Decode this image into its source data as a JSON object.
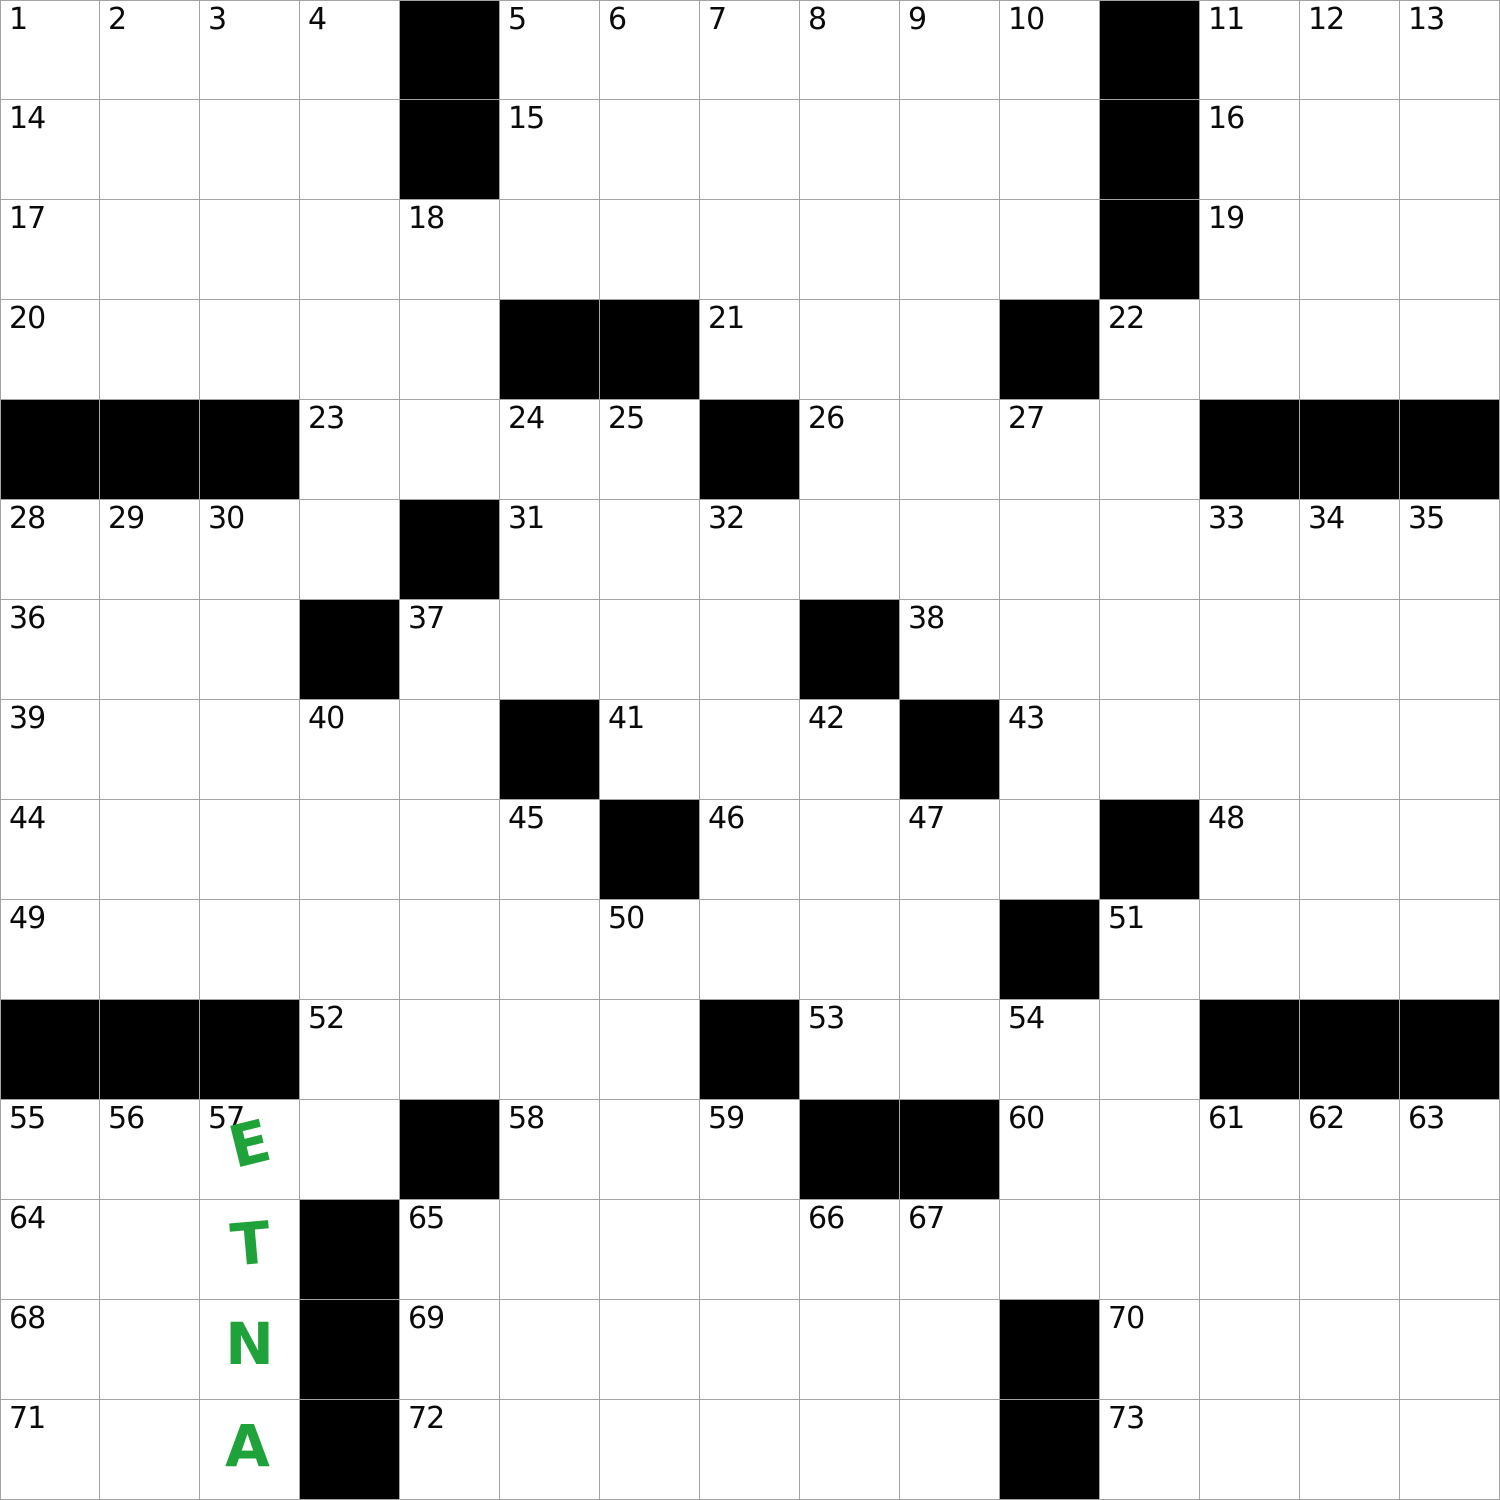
{
  "puzzle": {
    "rows": 15,
    "cols": 15,
    "cell_size": 100,
    "colors": {
      "background": "#ffffff",
      "black_cell": "#000000",
      "grid_line": "#a3a3a3",
      "number_text": "#0a0a0a",
      "entry_green": "#1fa23a"
    },
    "black_cells": [
      [
        0,
        4
      ],
      [
        0,
        11
      ],
      [
        1,
        4
      ],
      [
        1,
        11
      ],
      [
        2,
        11
      ],
      [
        3,
        5
      ],
      [
        3,
        6
      ],
      [
        3,
        10
      ],
      [
        4,
        0
      ],
      [
        4,
        1
      ],
      [
        4,
        2
      ],
      [
        4,
        7
      ],
      [
        4,
        12
      ],
      [
        4,
        13
      ],
      [
        4,
        14
      ],
      [
        5,
        4
      ],
      [
        6,
        3
      ],
      [
        6,
        8
      ],
      [
        7,
        5
      ],
      [
        7,
        9
      ],
      [
        8,
        6
      ],
      [
        8,
        11
      ],
      [
        9,
        10
      ],
      [
        10,
        0
      ],
      [
        10,
        1
      ],
      [
        10,
        2
      ],
      [
        10,
        7
      ],
      [
        10,
        12
      ],
      [
        10,
        13
      ],
      [
        10,
        14
      ],
      [
        11,
        4
      ],
      [
        11,
        8
      ],
      [
        11,
        9
      ],
      [
        12,
        3
      ],
      [
        13,
        3
      ],
      [
        13,
        10
      ],
      [
        14,
        3
      ],
      [
        14,
        10
      ]
    ],
    "numbers": [
      {
        "n": "1",
        "row": 0,
        "col": 0
      },
      {
        "n": "2",
        "row": 0,
        "col": 1
      },
      {
        "n": "3",
        "row": 0,
        "col": 2
      },
      {
        "n": "4",
        "row": 0,
        "col": 3
      },
      {
        "n": "5",
        "row": 0,
        "col": 5
      },
      {
        "n": "6",
        "row": 0,
        "col": 6
      },
      {
        "n": "7",
        "row": 0,
        "col": 7
      },
      {
        "n": "8",
        "row": 0,
        "col": 8
      },
      {
        "n": "9",
        "row": 0,
        "col": 9
      },
      {
        "n": "10",
        "row": 0,
        "col": 10
      },
      {
        "n": "11",
        "row": 0,
        "col": 12
      },
      {
        "n": "12",
        "row": 0,
        "col": 13
      },
      {
        "n": "13",
        "row": 0,
        "col": 14
      },
      {
        "n": "14",
        "row": 1,
        "col": 0
      },
      {
        "n": "15",
        "row": 1,
        "col": 5
      },
      {
        "n": "16",
        "row": 1,
        "col": 12
      },
      {
        "n": "17",
        "row": 2,
        "col": 0
      },
      {
        "n": "18",
        "row": 2,
        "col": 4
      },
      {
        "n": "19",
        "row": 2,
        "col": 12
      },
      {
        "n": "20",
        "row": 3,
        "col": 0
      },
      {
        "n": "21",
        "row": 3,
        "col": 7
      },
      {
        "n": "22",
        "row": 3,
        "col": 11
      },
      {
        "n": "23",
        "row": 4,
        "col": 3
      },
      {
        "n": "24",
        "row": 4,
        "col": 5
      },
      {
        "n": "25",
        "row": 4,
        "col": 6
      },
      {
        "n": "26",
        "row": 4,
        "col": 8
      },
      {
        "n": "27",
        "row": 4,
        "col": 10
      },
      {
        "n": "28",
        "row": 5,
        "col": 0
      },
      {
        "n": "29",
        "row": 5,
        "col": 1
      },
      {
        "n": "30",
        "row": 5,
        "col": 2
      },
      {
        "n": "31",
        "row": 5,
        "col": 5
      },
      {
        "n": "32",
        "row": 5,
        "col": 7
      },
      {
        "n": "33",
        "row": 5,
        "col": 12
      },
      {
        "n": "34",
        "row": 5,
        "col": 13
      },
      {
        "n": "35",
        "row": 5,
        "col": 14
      },
      {
        "n": "36",
        "row": 6,
        "col": 0
      },
      {
        "n": "37",
        "row": 6,
        "col": 4
      },
      {
        "n": "38",
        "row": 6,
        "col": 9
      },
      {
        "n": "39",
        "row": 7,
        "col": 0
      },
      {
        "n": "40",
        "row": 7,
        "col": 3
      },
      {
        "n": "41",
        "row": 7,
        "col": 6
      },
      {
        "n": "42",
        "row": 7,
        "col": 8
      },
      {
        "n": "43",
        "row": 7,
        "col": 10
      },
      {
        "n": "44",
        "row": 8,
        "col": 0
      },
      {
        "n": "45",
        "row": 8,
        "col": 5
      },
      {
        "n": "46",
        "row": 8,
        "col": 7
      },
      {
        "n": "47",
        "row": 8,
        "col": 9
      },
      {
        "n": "48",
        "row": 8,
        "col": 12
      },
      {
        "n": "49",
        "row": 9,
        "col": 0
      },
      {
        "n": "50",
        "row": 9,
        "col": 6
      },
      {
        "n": "51",
        "row": 9,
        "col": 11
      },
      {
        "n": "52",
        "row": 10,
        "col": 3
      },
      {
        "n": "53",
        "row": 10,
        "col": 8
      },
      {
        "n": "54",
        "row": 10,
        "col": 10
      },
      {
        "n": "55",
        "row": 11,
        "col": 0
      },
      {
        "n": "56",
        "row": 11,
        "col": 1
      },
      {
        "n": "57",
        "row": 11,
        "col": 2
      },
      {
        "n": "58",
        "row": 11,
        "col": 5
      },
      {
        "n": "59",
        "row": 11,
        "col": 7
      },
      {
        "n": "60",
        "row": 11,
        "col": 10
      },
      {
        "n": "61",
        "row": 11,
        "col": 12
      },
      {
        "n": "62",
        "row": 11,
        "col": 13
      },
      {
        "n": "63",
        "row": 11,
        "col": 14
      },
      {
        "n": "64",
        "row": 12,
        "col": 0
      },
      {
        "n": "65",
        "row": 12,
        "col": 4
      },
      {
        "n": "66",
        "row": 12,
        "col": 8
      },
      {
        "n": "67",
        "row": 12,
        "col": 9
      },
      {
        "n": "68",
        "row": 13,
        "col": 0
      },
      {
        "n": "69",
        "row": 13,
        "col": 4
      },
      {
        "n": "70",
        "row": 13,
        "col": 11
      },
      {
        "n": "71",
        "row": 14,
        "col": 0
      },
      {
        "n": "72",
        "row": 14,
        "col": 4
      },
      {
        "n": "73",
        "row": 14,
        "col": 11
      }
    ],
    "entries": [
      {
        "letter": "E",
        "row": 11,
        "col": 2
      },
      {
        "letter": "T",
        "row": 12,
        "col": 2
      },
      {
        "letter": "N",
        "row": 13,
        "col": 2
      },
      {
        "letter": "A",
        "row": 14,
        "col": 2
      }
    ]
  }
}
